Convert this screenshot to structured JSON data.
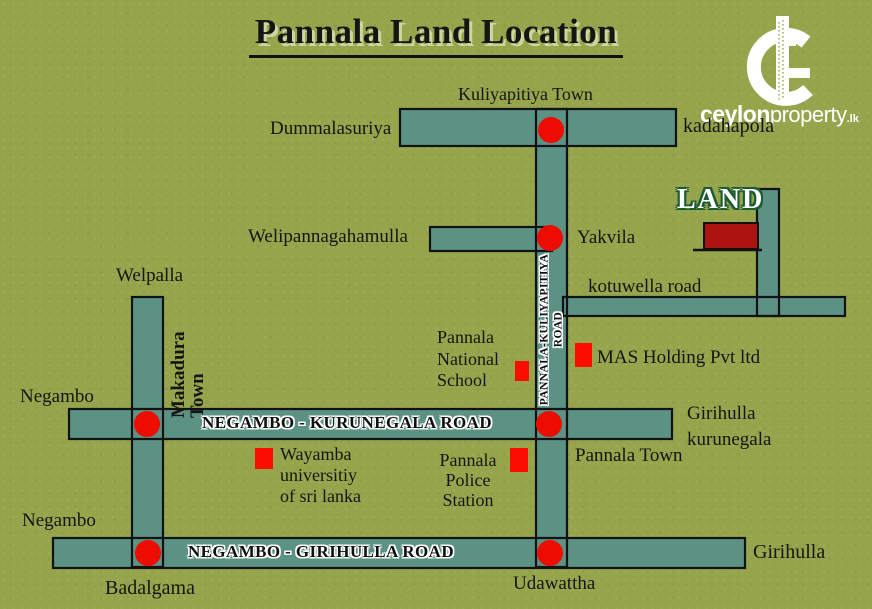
{
  "title": "Pannala Land Location",
  "logo": {
    "brand_bold": "ceylon",
    "brand_light": "property",
    "brand_tld": ".lk"
  },
  "icons": {
    "logo_mark": "c-swirl-with-skyscraper"
  },
  "labels": {
    "kuliyapitiya_town": "Kuliyapitiya Town",
    "dummalasuriya": "Dummalasuriya",
    "kadahapola": "kadahapola",
    "welipannagahamulla": "Welipannagahamulla",
    "yakvila": "Yakvila",
    "land": "LAND",
    "kotuwella_road": "kotuwella road",
    "welpalla": "Welpalla",
    "makadura_town": [
      "Makadura",
      "Town"
    ],
    "pannala_kuliyapitiya_road": [
      "PANNALA-KULIYAPITIYA",
      "ROAD"
    ],
    "pannala_national_school": [
      "Pannala",
      "National",
      "School"
    ],
    "mas_holding": "MAS Holding Pvt ltd",
    "negambo_top": "Negambo",
    "negambo_kurunegala_road": "NEGAMBO - KURUNEGALA ROAD",
    "girihulla_kurunegala": [
      "Girihulla",
      "kurunegala"
    ],
    "pannala_town": "Pannala Town",
    "wayamba_university": [
      "Wayamba",
      "universitiy",
      "of sri lanka"
    ],
    "pannala_police_station": [
      "Pannala",
      "Police",
      "Station"
    ],
    "negambo_bottom": "Negambo",
    "negambo_girihulla_road": "NEGAMBO - GIRIHULLA ROAD",
    "girihulla": "Girihulla",
    "badalgama": "Badalgama",
    "udawattha": "Udawattha"
  },
  "colors": {
    "background": "#96a44c",
    "road_fill": "#5b9283",
    "road_border": "#121212",
    "marker_red": "#ee0b00",
    "poi_red": "#fb0e00",
    "land_fill": "#ad1311",
    "land_text": "#ffffff",
    "land_outline": "#1c5c33",
    "ink": "#151515",
    "road_label_ink": "#101010",
    "title_shadow": "#ccd79e",
    "logo_white": "#ffffff"
  }
}
